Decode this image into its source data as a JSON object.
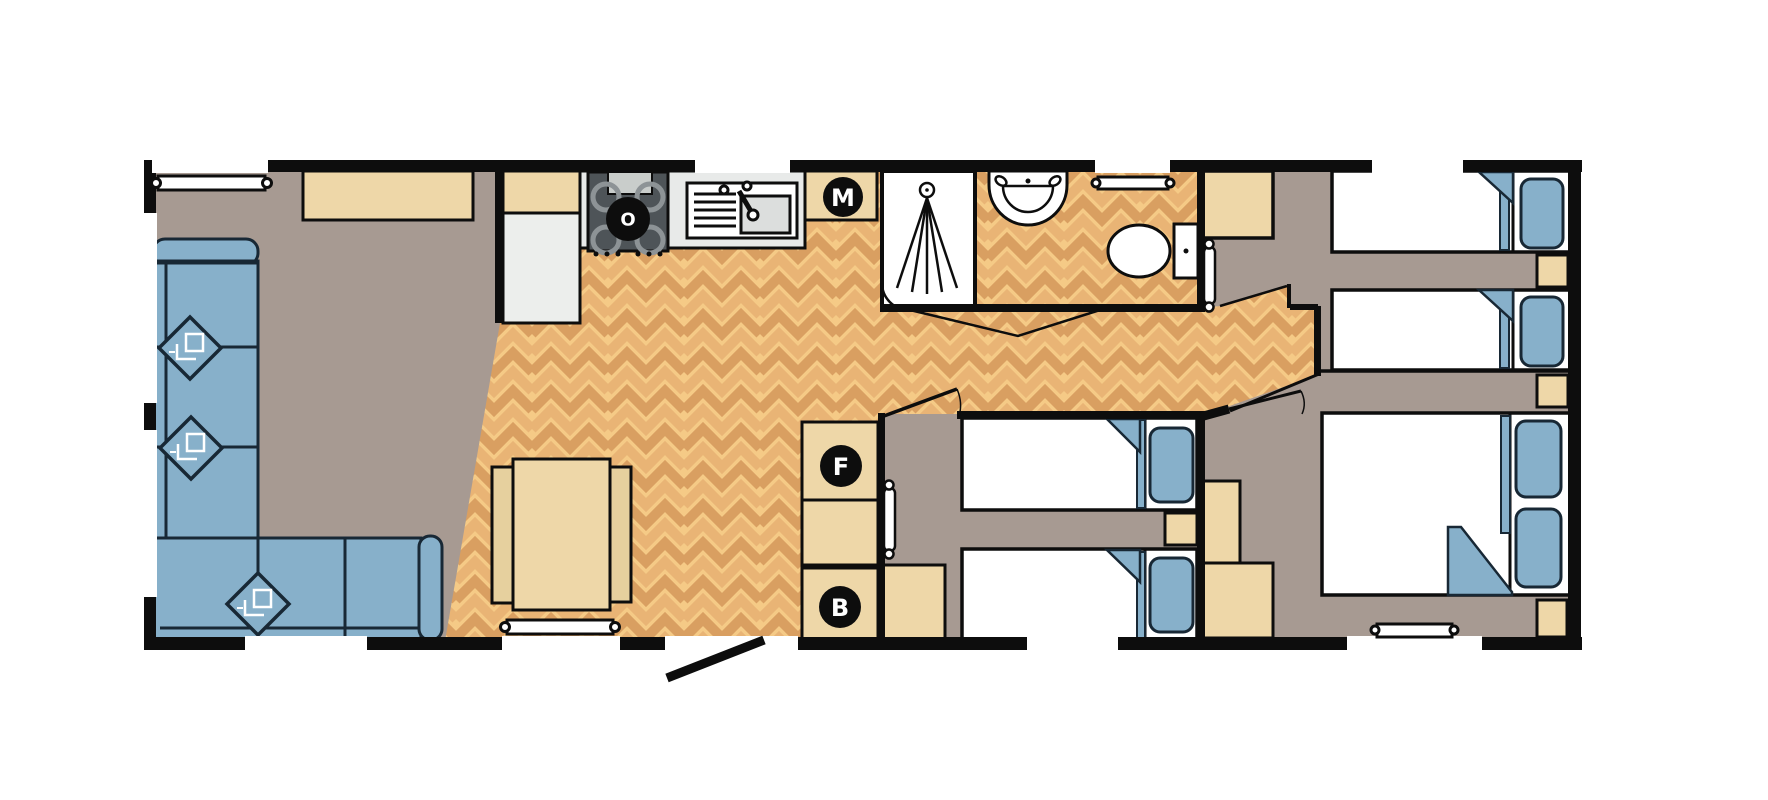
{
  "markers": {
    "o": "O",
    "m": "M",
    "f": "F",
    "b": "B"
  },
  "palette": {
    "wall": "#0d0d0d",
    "carpet": "#a79a92",
    "wood_base": "#f5ca86",
    "wood_stripe_dark": "#d99f61",
    "wood_stripe_mid": "#e9b475",
    "furniture_beige": "#eed7a8",
    "upholstery_blue": "#87b0ca",
    "outline_navy": "#182835",
    "worktop_grey": "#e8eae9",
    "hob_grey": "#4e5458",
    "marker_bg": "#0d0d0d",
    "marker_text": "#ffffff"
  }
}
